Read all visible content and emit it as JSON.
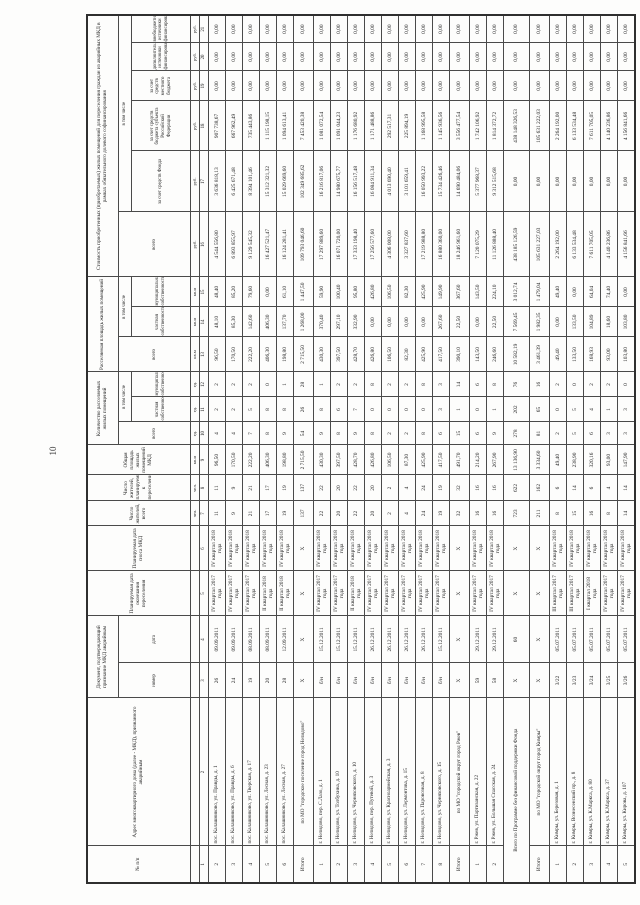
{
  "page": {
    "number": "10"
  },
  "table": {
    "header": {
      "col1": "№ п/п",
      "col2": "Адрес многоквартирного дома (далее - МКД), признанного аварийным",
      "doc_group": "Документ, подтверждающий признание МКД аварийным",
      "doc_number": "номер",
      "doc_date": "дата",
      "col5": "Планируемая дата окончания переселения",
      "col6": "Планируемая дата сноса МКД",
      "col7": "Число жителей, всего",
      "col8": "Число жителей, планируемых к переселению",
      "col9": "Общая площадь жилых помещений МКД",
      "count_group": "Количество расселяемых жилых помещений",
      "area_group": "Расселяемая площадь жилых помещений",
      "cost_group": "Стоимость приобретенных (приобретаемых) жилых помещений для переселения граждан из аварийных МКД в рамках обязательного долевого софинансирования",
      "in_total": "в том числе",
      "total": "всего",
      "private": "частная собственность",
      "municipal": "муниципальная собственность",
      "fund": "за счет средств Фонда",
      "region": "за счет средств бюджета субъекта Российской Федерации",
      "local": "за счет средств местного бюджета",
      "additional": "дополнительные источники финансирования",
      "extra": "внебюджетные источники финансирования",
      "units_row": [
        "",
        "",
        "",
        "",
        "",
        "",
        "чел.",
        "чел.",
        "кв.м",
        "ед.",
        "ед.",
        "ед.",
        "кв.м",
        "кв.м",
        "кв.м",
        "руб.",
        "руб.",
        "руб.",
        "руб.",
        "руб.",
        "руб."
      ],
      "numbers_row": [
        "1",
        "2",
        "3",
        "4",
        "5",
        "6",
        "7",
        "8",
        "9",
        "10",
        "11",
        "12",
        "13",
        "14",
        "15",
        "16",
        "17",
        "18",
        "19",
        "20",
        "21"
      ]
    },
    "rows": [
      {
        "kind": "data",
        "cells": [
          "2",
          "пос. Калашниково, ул. Правды, д. 1",
          "26",
          "09.09.2011",
          "IV квартал 2017 года",
          "IV квартал 2018 года",
          "11",
          "11",
          "96,50",
          "4",
          "2",
          "2",
          "96,50",
          "48,10",
          "48,40",
          "4 544 556,80",
          "3 636 818,13",
          "907 738,67",
          "0,00",
          "0,00",
          "0,00"
        ]
      },
      {
        "kind": "data",
        "cells": [
          "3",
          "пос. Калашниково, ул. Правды, д. 6",
          "24",
          "09.09.2011",
          "IV квартал 2017 года",
          "IV квартал 2018 года",
          "9",
          "9",
          "170,50",
          "4",
          "2",
          "2",
          "170,50",
          "85,30",
          "85,20",
          "6 893 855,97",
          "6 425 671,48",
          "667 962,49",
          "0,00",
          "0,00",
          "0,00"
        ]
      },
      {
        "kind": "data",
        "cells": [
          "4",
          "пос. Калашниково, ул. Тверская, д. 17",
          "19",
          "08.09.2011",
          "IV квартал 2017 года",
          "IV квартал 2018 года",
          "21",
          "21",
          "222,20",
          "7",
          "5",
          "2",
          "222,20",
          "142,60",
          "79,60",
          "9 129 545,32",
          "8 394 101,46",
          "735 443,86",
          "0,00",
          "0,00",
          "0,00"
        ]
      },
      {
        "kind": "data",
        "cells": [
          "5",
          "пос. Калашниково, ул. Лесная, д. 23",
          "20",
          "08.09.2011",
          "II квартал 2018 года",
          "IV квартал 2018 года",
          "17",
          "17",
          "406,30",
          "8",
          "8",
          "0",
          "406,30",
          "406,30",
          "0,00",
          "16 427 521,47",
          "15 312 321,32",
          "1 115 198,15",
          "0,00",
          "0,00",
          "0,00"
        ]
      },
      {
        "kind": "data",
        "cells": [
          "6",
          "пос. Калашниково, ул. Лесная, д. 27",
          "28",
          "12.09.2011",
          "II квартал 2018 года",
          "IV квартал 2018 года",
          "19",
          "19",
          "198,80",
          "9",
          "8",
          "1",
          "198,80",
          "137,70",
          "61,10",
          "16 124 281,41",
          "15 029 669,60",
          "1 094 613,41",
          "0,00",
          "0,00",
          "0,00"
        ]
      },
      {
        "kind": "subtotal",
        "cells": [
          "Итого",
          "по МО \"городское поселение город Нелидово\"",
          "Х",
          "Х",
          "Х",
          "Х",
          "137",
          "137",
          "2 715,50",
          "54",
          "26",
          "28",
          "2 715,50",
          "1 268,00",
          "1 447,50",
          "109 793 046,60",
          "102 349 685,62",
          "7 453 420,38",
          "0,00",
          "0,00",
          "0,00"
        ]
      },
      {
        "kind": "data",
        "cells": [
          "1",
          "г. Нелидово, пер. С.Лазо, д. 1",
          "б/н",
          "15.12.2011",
          "IV квартал 2017 года",
          "IV квартал 2018 года",
          "22",
          "22",
          "430,30",
          "9",
          "8",
          "1",
          "430,30",
          "370,40",
          "59,90",
          "17 297 889,60",
          "16 216 817,06",
          "1 081 072,54",
          "0,00",
          "0,00",
          "0,00"
        ]
      },
      {
        "kind": "data",
        "cells": [
          "2",
          "г. Нелидово, ул. Толбухина, д. 10",
          "б/н",
          "15.12.2011",
          "IV квартал 2017 года",
          "IV квартал 2018 года",
          "20",
          "20",
          "397,50",
          "8",
          "6",
          "2",
          "397,50",
          "297,10",
          "100,40",
          "16 071 720,00",
          "14 980 675,77",
          "1 091 044,23",
          "0,00",
          "0,00",
          "0,00"
        ]
      },
      {
        "kind": "data",
        "cells": [
          "3",
          "г. Нелидово, ул. Черняховского, д. 10",
          "б/н",
          "15.12.2011",
          "II квартал 2018 года",
          "IV квартал 2018 года",
          "22",
          "22",
          "428,70",
          "9",
          "7",
          "2",
          "428,70",
          "332,90",
          "95,80",
          "17 333 198,40",
          "16 156 517,48",
          "1 176 680,92",
          "0,00",
          "0,00",
          "0,00"
        ]
      },
      {
        "kind": "data",
        "cells": [
          "4",
          "г. Нелидово, пер. Путевой, д. 3",
          "б/н",
          "26.12.2011",
          "IV квартал 2017 года",
          "IV квартал 2018 года",
          "20",
          "20",
          "426,80",
          "8",
          "0",
          "8",
          "426,80",
          "0,00",
          "426,80",
          "17 256 577,60",
          "16 084 911,34",
          "1 171 488,86",
          "0,00",
          "0,00",
          "0,00"
        ]
      },
      {
        "kind": "data",
        "cells": [
          "5",
          "г. Нелидово, ул. Красноармейская, д. 3",
          "б/н",
          "26.12.2011",
          "IV квартал 2017 года",
          "IV квартал 2018 года",
          "2",
          "2",
          "106,50",
          "2",
          "0",
          "2",
          "106,50",
          "0,00",
          "106,50",
          "4 306 008,00",
          "4 013 690,40",
          "292 517,31",
          "0,00",
          "0,00",
          "0,00"
        ]
      },
      {
        "kind": "data",
        "cells": [
          "6",
          "г. Нелидово, ул. Лермонтова, д. 15",
          "б/н",
          "26.12.2011",
          "IV квартал 2017 года",
          "IV квартал 2018 года",
          "4",
          "4",
          "87,30",
          "2",
          "0",
          "2",
          "82,30",
          "0,00",
          "82,30",
          "3 327 837,60",
          "3 101 659,41",
          "225 894,19",
          "0,00",
          "0,00",
          "0,00"
        ]
      },
      {
        "kind": "data",
        "cells": [
          "7",
          "г. Нелидово, ул. Паровозная, д. 8",
          "б/н",
          "26.12.2011",
          "IV квартал 2017 года",
          "IV квартал 2018 года",
          "24",
          "24",
          "425,90",
          "8",
          "0",
          "8",
          "425,90",
          "0,00",
          "425,90",
          "17 219 988,80",
          "16 050 993,22",
          "1 168 995,58",
          "0,00",
          "0,00",
          "0,00"
        ]
      },
      {
        "kind": "data",
        "cells": [
          "8",
          "г. Нелидово, ул. Черняховского, д. 15",
          "б/н",
          "15.12.2011",
          "IV квартал 2017 года",
          "IV квартал 2018 года",
          "19",
          "19",
          "417,50",
          "6",
          "3",
          "3",
          "417,50",
          "267,60",
          "149,90",
          "16 880 360,00",
          "15 734 426,46",
          "1 145 936,56",
          "0,00",
          "0,00",
          "0,00"
        ]
      },
      {
        "kind": "subtotal",
        "cells": [
          "Итого",
          "по МО \"городской округ город Ржев\"",
          "Х",
          "Х",
          "Х",
          "Х",
          "32",
          "32",
          "491,70",
          "15",
          "1",
          "14",
          "390,10",
          "22,50",
          "367,60",
          "18 246 961,60",
          "14 690 484,06",
          "3 556 477,54",
          "0,00",
          "0,00",
          "0,00"
        ]
      },
      {
        "kind": "data",
        "cells": [
          "1",
          "г. Ржев, ул. Партизанская, д. 22",
          "59",
          "29.12.2011",
          "IV квартал 2017 года",
          "IV квартал 2018 года",
          "16",
          "16",
          "214,20",
          "6",
          "0",
          "6",
          "143,50",
          "0,00",
          "143,50",
          "7 120 075,29",
          "5 377 968,37",
          "1 742 106,92",
          "0,00",
          "0,00",
          "0,00"
        ]
      },
      {
        "kind": "data",
        "cells": [
          "2",
          "г. Ржев, ул. Большая Спасская, д. 24",
          "58",
          "29.12.2011",
          "IV квартал 2017 года",
          "IV квартал 2018 года",
          "16",
          "16",
          "267,90",
          "9",
          "1",
          "8",
          "246,60",
          "22,50",
          "224,10",
          "11 126 888,40",
          "9 312 515,68",
          "1 814 372,72",
          "0,00",
          "0,00",
          "0,00"
        ]
      },
      {
        "kind": "total",
        "span2": true,
        "cells": [
          "Всего по Программе без финансовой поддержки Фонда",
          "Х",
          "60",
          "Х",
          "Х",
          "723",
          "622",
          "13 136,90",
          "278",
          "202",
          "76",
          "10 582,19",
          "7 569,45",
          "3 012,74",
          "438 185 126,59",
          "0,00",
          "438 148 326,53",
          "0,00",
          "0,00",
          "0,00"
        ]
      },
      {
        "kind": "subtotal",
        "cells": [
          "Итого",
          "по МО \"городской округ город Кимры\"",
          "Х",
          "Х",
          "Х",
          "Х",
          "211",
          "162",
          "3 334,60",
          "81",
          "65",
          "16",
          "3 461,39",
          "1 982,35",
          "1 479,04",
          "105 631 227,03",
          "0,00",
          "105 631 222,03",
          "0,00",
          "0,00",
          "0,00"
        ]
      },
      {
        "kind": "data",
        "cells": [
          "1",
          "г. Кимры, ул. Березовая, д. 1",
          "3/22",
          "05.07.2011",
          "III квартал 2017 года",
          "IV квартал 2018 года",
          "8",
          "6",
          "49,40",
          "2",
          "0",
          "2",
          "49,40",
          "0,00",
          "49,40",
          "2 264 192,00",
          "0,00",
          "2 264 192,00",
          "0,00",
          "0,00",
          "0,00"
        ]
      },
      {
        "kind": "data",
        "cells": [
          "2",
          "г. Кимры, Вознесенский пр., д. 8",
          "3/23",
          "05.07.2011",
          "III квартал 2017 года",
          "IV квартал 2018 года",
          "15",
          "14",
          "238,90",
          "5",
          "5",
          "0",
          "133,50",
          "133,50",
          "0,00",
          "6 133 534,48",
          "0,00",
          "6 133 534,48",
          "0,00",
          "0,00",
          "0,00"
        ]
      },
      {
        "kind": "data",
        "cells": [
          "3",
          "г. Кимры, ул. К.Маркса, д. 80",
          "3/24",
          "05.07.2011",
          "I квартал 2018 года",
          "IV квартал 2018 года",
          "16",
          "6",
          "320,16",
          "6",
          "4",
          "2",
          "168,93",
          "104,89",
          "64,04",
          "7 611 705,05",
          "0,00",
          "7 611 705,05",
          "0,00",
          "0,00",
          "0,00"
        ]
      },
      {
        "kind": "data",
        "cells": [
          "4",
          "г. Кимры, ул. К.Маркса, д. 37",
          "3/25",
          "05.07.2011",
          "IV квартал 2017 года",
          "IV квартал 2018 года",
          "8",
          "4",
          "93,00",
          "3",
          "1",
          "2",
          "93,00",
          "18,60",
          "74,40",
          "4 140 236,86",
          "0,00",
          "4 140 236,86",
          "0,00",
          "0,00",
          "0,00"
        ]
      },
      {
        "kind": "data",
        "cells": [
          "5",
          "г. Кимры, ул. Кирова, д. 107",
          "3/26",
          "05.07.2011",
          "IV квартал 2017 года",
          "IV квартал 2018 года",
          "14",
          "14",
          "147,90",
          "3",
          "3",
          "0",
          "103,80",
          "103,80",
          "0,00",
          "4 156 841,66",
          "0,00",
          "4 156 841,66",
          "0,00",
          "0,00",
          "0,00"
        ]
      }
    ]
  }
}
